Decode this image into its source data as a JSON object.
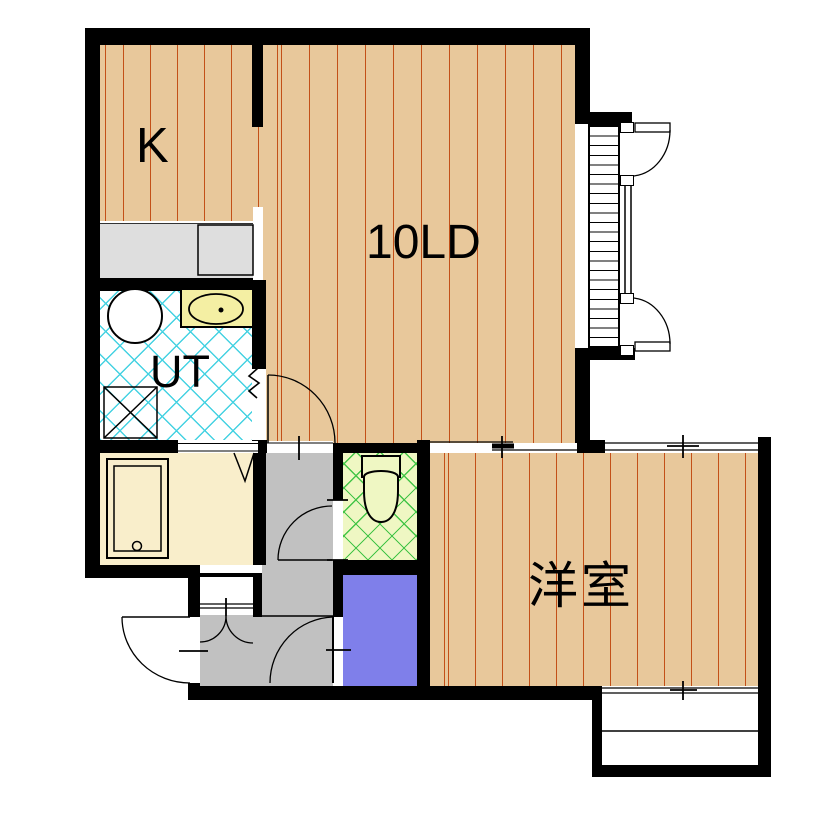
{
  "plan": {
    "type": "apartment-floor-plan",
    "rooms": {
      "kitchen": {
        "label": "K"
      },
      "living_dining": {
        "label": "10LD"
      },
      "utility": {
        "label": "UT"
      },
      "western_room": {
        "label": "洋室"
      }
    },
    "fixtures": [
      "kitchen-counter",
      "sink-unit",
      "laundry-sink",
      "washbasin",
      "washing-machine-pan",
      "bathtub",
      "toilet",
      "shoe-cabinet",
      "storage-closet",
      "bay-window",
      "balcony",
      "entrance-door"
    ],
    "colors": {
      "wall": "#000000",
      "wood_floor": "#e8c89b",
      "wood_floor_stripe": "#c35018",
      "utility_tile_line": "#45d2e2",
      "toilet_floor": "#eff7c3",
      "toilet_tile_line": "#44c548",
      "bathroom_floor": "#f9eecb",
      "closet_fill": "#7f7fea",
      "hallway_fill": "#c1c1c1",
      "counter_fill": "#dedede",
      "washbasin_fill": "#f4efa3"
    }
  }
}
